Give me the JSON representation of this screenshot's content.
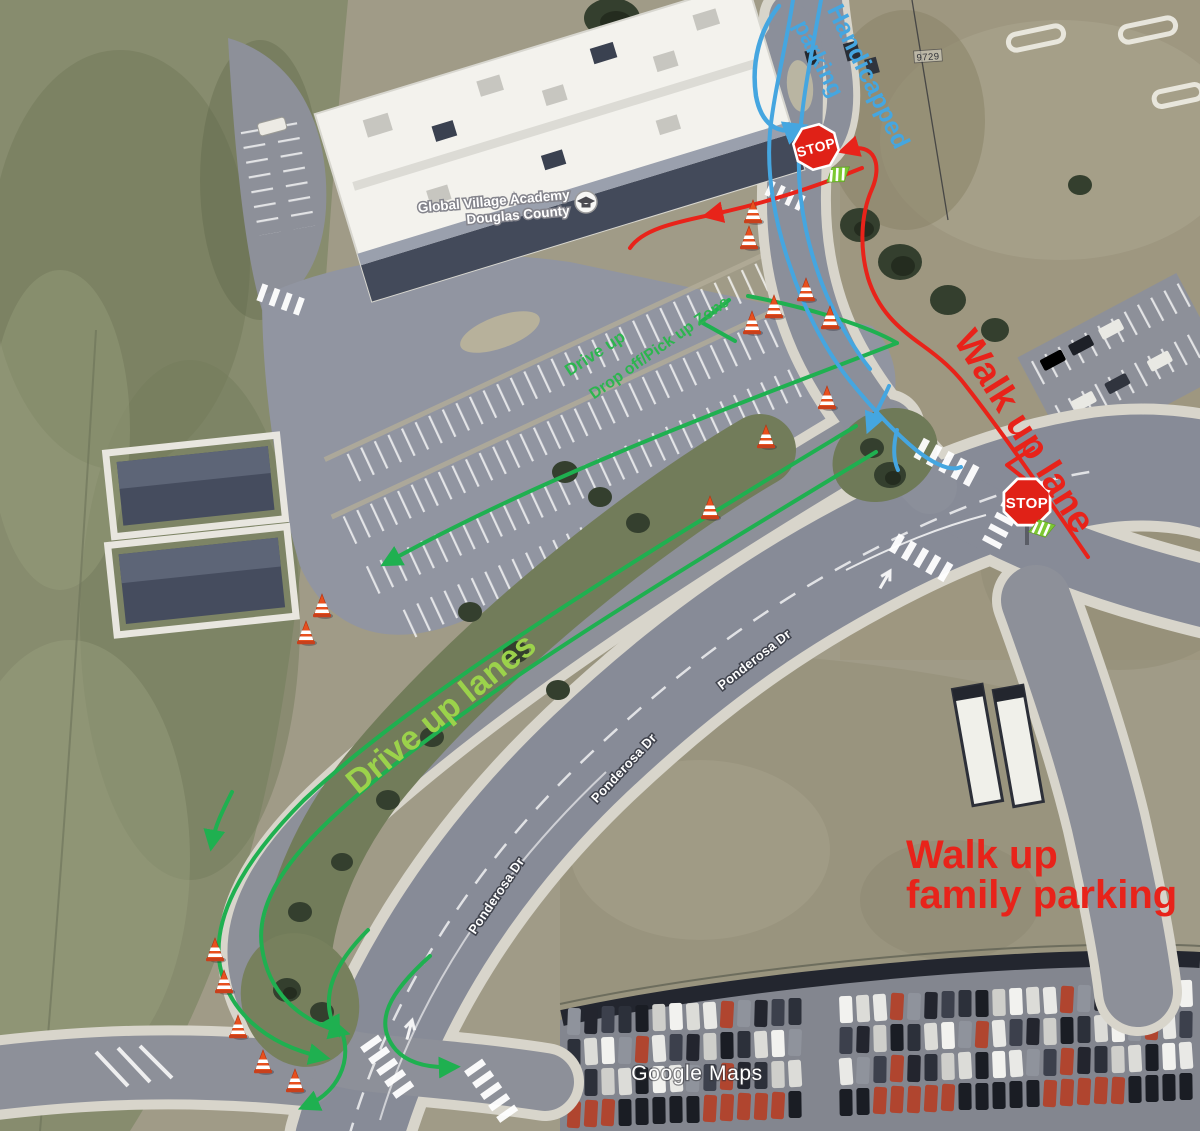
{
  "map": {
    "attribution": "Google Maps",
    "parcel_label": "9729",
    "place": {
      "name_line1": "Global Village Academy",
      "name_line2": "Douglas County",
      "marker_icon": "school-marker-icon"
    },
    "street_labels": [
      {
        "text": "Ponderosa Dr",
        "x": 500,
        "y": 898,
        "rot": -56
      },
      {
        "text": "Ponderosa Dr",
        "x": 627,
        "y": 771,
        "rot": -47
      },
      {
        "text": "Ponderosa Dr",
        "x": 757,
        "y": 663,
        "rot": -38
      }
    ]
  },
  "annotations": {
    "colors": {
      "green": "#1fb050",
      "light_green": "#9bd24b",
      "red": "#e8231a",
      "blue": "#45a6e0",
      "cone": "#e8501e"
    },
    "labels": [
      {
        "id": "handicapped-parking-line1",
        "text": "Handicapped",
        "x": 861,
        "y": 80,
        "rot": 64,
        "size": 25,
        "weight": "bold",
        "color": "#45a6e0"
      },
      {
        "id": "handicapped-parking-line2",
        "text": "parking",
        "x": 812,
        "y": 62,
        "rot": 63,
        "size": 23,
        "weight": "bold",
        "color": "#45a6e0"
      },
      {
        "id": "walk-up-lane",
        "text": "Walk up lane",
        "x": 1014,
        "y": 438,
        "rot": 58,
        "size": 38,
        "weight": "bold",
        "color": "#e8231a"
      },
      {
        "id": "drive-up-lanes",
        "text": "Drive up lanes",
        "x": 448,
        "y": 722,
        "rot": -39,
        "size": 34,
        "weight": "bold",
        "color": "#9bd24b"
      },
      {
        "id": "drop-zone-line1",
        "text": "Drive up",
        "x": 598,
        "y": 358,
        "rot": -33,
        "size": 17,
        "weight": "bold",
        "color": "#2db54f"
      },
      {
        "id": "drop-zone-line2",
        "text": "Drop off/Pick up Zone",
        "x": 662,
        "y": 352,
        "rot": -35,
        "size": 16,
        "weight": "bold",
        "color": "#2db54f"
      },
      {
        "id": "walk-up-family-line1",
        "text": "Walk up",
        "x": 906,
        "y": 868,
        "rot": 0,
        "size": 40,
        "weight": "bold",
        "color": "#e8231a",
        "anchor": "start"
      },
      {
        "id": "walk-up-family-line2",
        "text": "family parking",
        "x": 906,
        "y": 908,
        "rot": 0,
        "size": 40,
        "weight": "bold",
        "color": "#e8231a",
        "anchor": "start"
      }
    ],
    "stop_signs": [
      {
        "x": 816,
        "y": 147,
        "rot": -15,
        "size": 46,
        "label": "STOP"
      },
      {
        "x": 1027,
        "y": 502,
        "rot": 0,
        "size": 50,
        "label": "STOP"
      }
    ],
    "crossing_markers": [
      {
        "x": 838,
        "y": 174,
        "rot": -15
      },
      {
        "x": 1042,
        "y": 528,
        "rot": 5
      }
    ],
    "cones": [
      [
        753,
        212
      ],
      [
        749,
        238
      ],
      [
        806,
        290
      ],
      [
        774,
        307
      ],
      [
        752,
        323
      ],
      [
        830,
        318
      ],
      [
        827,
        398
      ],
      [
        766,
        437
      ],
      [
        710,
        508
      ],
      [
        322,
        606
      ],
      [
        306,
        633
      ],
      [
        215,
        950
      ],
      [
        224,
        982
      ],
      [
        238,
        1027
      ],
      [
        263,
        1062
      ],
      [
        295,
        1081
      ]
    ],
    "routes": {
      "green": [
        {
          "d": "M 748,296 C 810,308 868,326 897,343",
          "w": 4
        },
        {
          "d": "M 897,343 C 760,396 555,470 388,562",
          "w": 4,
          "ae": true
        },
        {
          "d": "M 729,300 L 701,322 L 735,341",
          "w": 4
        },
        {
          "d": "M 856,426 C 640,556 418,692 304,800 C 238,866 212,922 220,966 C 228,1010 264,1044 322,1057",
          "w": 4,
          "ae": true
        },
        {
          "d": "M 876,452 C 664,580 448,710 334,816 C 280,866 256,908 262,948 C 268,990 296,1020 342,1032",
          "w": 4,
          "ae": true
        },
        {
          "d": "M 232,792 C 222,812 215,826 212,843",
          "w": 4,
          "ae": true
        },
        {
          "d": "M 430,956 C 390,992 372,1022 396,1050 C 408,1063 428,1068 452,1067",
          "w": 4,
          "ae": true
        },
        {
          "d": "M 368,930 C 336,962 318,996 336,1030",
          "w": 4,
          "ae": true
        },
        {
          "d": "M 342,1032 C 352,1062 338,1092 306,1106",
          "w": 4,
          "ae": true
        }
      ],
      "red": [
        {
          "d": "M 862,168 C 800,193 752,206 710,215",
          "w": 4,
          "ae": true
        },
        {
          "d": "M 710,215 C 672,223 642,230 630,248",
          "w": 4
        },
        {
          "d": "M 846,150 C 876,141 882,166 872,189 C 860,216 860,250 868,278 C 878,310 898,328 922,345 C 940,358 954,370 966,386 C 1006,437 1050,502 1088,557",
          "w": 4,
          "as": true
        },
        {
          "d": "M 1033,448 L 1007,465 L 1030,483",
          "w": 4
        }
      ],
      "blue": [
        {
          "d": "M 793,0 C 786,46 774,92 770,132 C 766,176 776,226 790,266 C 802,303 822,346 850,381 C 872,408 893,431 916,450 C 938,467 952,471 961,467",
          "w": 4
        },
        {
          "d": "M 821,0 C 812,52 801,102 799,152 C 797,206 810,256 827,296 C 838,321 852,346 870,369",
          "w": 4
        },
        {
          "d": "M 779,6 C 760,29 751,62 756,96 C 761,123 777,136 799,128",
          "w": 4.5,
          "ae": true
        },
        {
          "d": "M 889,386 C 882,402 875,414 870,426",
          "w": 4,
          "ae": true
        },
        {
          "d": "M 897,430 C 893,446 893,459 898,470",
          "w": 4
        }
      ]
    }
  }
}
